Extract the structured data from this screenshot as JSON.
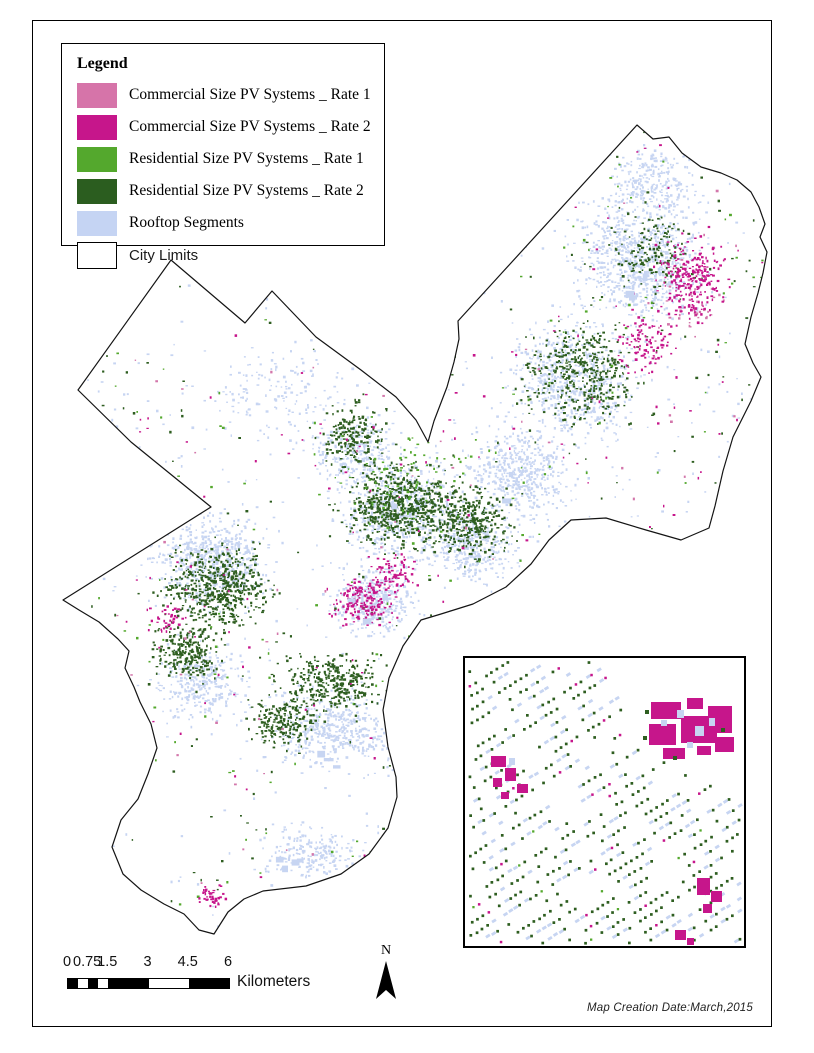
{
  "legend": {
    "title": "Legend",
    "items": [
      {
        "label": "Commercial Size PV Systems _ Rate 1",
        "color": "#d674a9",
        "outlined": false,
        "sans": false
      },
      {
        "label": "Commercial Size PV Systems _ Rate 2",
        "color": "#c6168b",
        "outlined": false,
        "sans": false
      },
      {
        "label": "Residential Size PV Systems _ Rate 1",
        "color": "#54a82d",
        "outlined": false,
        "sans": false
      },
      {
        "label": "Residential Size PV Systems _ Rate 2",
        "color": "#2b5d1f",
        "outlined": false,
        "sans": false
      },
      {
        "label": "Rooftop Segments",
        "color": "#c5d4f3",
        "outlined": false,
        "sans": false
      },
      {
        "label": "City Limits",
        "color": "#ffffff",
        "outlined": true,
        "sans": true
      }
    ]
  },
  "scalebar": {
    "unit": "Kilometers",
    "max_km": 6,
    "bar_px": 161,
    "tick_labels": [
      {
        "km": 0,
        "text": "0"
      },
      {
        "km": 0.75,
        "text": "0.75"
      },
      {
        "km": 1.5,
        "text": "1.5"
      },
      {
        "km": 3,
        "text": "3"
      },
      {
        "km": 4.5,
        "text": "4.5"
      },
      {
        "km": 6,
        "text": "6"
      }
    ],
    "segments": [
      {
        "from": 0,
        "to": 0.375,
        "fill": "#000000"
      },
      {
        "from": 0.375,
        "to": 0.75,
        "fill": "#ffffff"
      },
      {
        "from": 0.75,
        "to": 1.125,
        "fill": "#000000"
      },
      {
        "from": 1.125,
        "to": 1.5,
        "fill": "#ffffff"
      },
      {
        "from": 1.5,
        "to": 3,
        "fill": "#000000"
      },
      {
        "from": 3,
        "to": 4.5,
        "fill": "#ffffff"
      },
      {
        "from": 4.5,
        "to": 6,
        "fill": "#000000"
      }
    ]
  },
  "north_arrow": {
    "label": "N"
  },
  "footer": {
    "date_note": "Map Creation Date:March,2015"
  },
  "map": {
    "seed": 1337,
    "colors": {
      "com1": "#d377ab",
      "com2": "#c6168b",
      "res1": "#54a82d",
      "res2": "#2e5e20",
      "rooftop": "#c7d5f2",
      "outline": "#141414"
    },
    "outline_points": [
      [
        636,
        124
      ],
      [
        652,
        138
      ],
      [
        668,
        136
      ],
      [
        681,
        152
      ],
      [
        700,
        166
      ],
      [
        720,
        172
      ],
      [
        736,
        179
      ],
      [
        750,
        191
      ],
      [
        758,
        206
      ],
      [
        764,
        223
      ],
      [
        759,
        236
      ],
      [
        766,
        251
      ],
      [
        762,
        272
      ],
      [
        757,
        292
      ],
      [
        750,
        316
      ],
      [
        744,
        343
      ],
      [
        752,
        362
      ],
      [
        760,
        376
      ],
      [
        750,
        400
      ],
      [
        732,
        436
      ],
      [
        722,
        470
      ],
      [
        714,
        505
      ],
      [
        708,
        527
      ],
      [
        680,
        539
      ],
      [
        645,
        529
      ],
      [
        605,
        517
      ],
      [
        570,
        519
      ],
      [
        548,
        539
      ],
      [
        530,
        563
      ],
      [
        505,
        586
      ],
      [
        472,
        603
      ],
      [
        440,
        613
      ],
      [
        420,
        619
      ],
      [
        402,
        645
      ],
      [
        388,
        677
      ],
      [
        382,
        709
      ],
      [
        387,
        746
      ],
      [
        395,
        776
      ],
      [
        396,
        796
      ],
      [
        387,
        827
      ],
      [
        368,
        853
      ],
      [
        340,
        873
      ],
      [
        305,
        885
      ],
      [
        262,
        890
      ],
      [
        243,
        898
      ],
      [
        227,
        911
      ],
      [
        213,
        933
      ],
      [
        198,
        929
      ],
      [
        183,
        913
      ],
      [
        163,
        903
      ],
      [
        140,
        889
      ],
      [
        122,
        873
      ],
      [
        111,
        846
      ],
      [
        120,
        819
      ],
      [
        137,
        798
      ],
      [
        147,
        773
      ],
      [
        156,
        747
      ],
      [
        150,
        723
      ],
      [
        139,
        701
      ],
      [
        133,
        686
      ],
      [
        124,
        667
      ],
      [
        128,
        650
      ],
      [
        117,
        638
      ],
      [
        98,
        621
      ],
      [
        78,
        609
      ],
      [
        62,
        599
      ],
      [
        210,
        506
      ],
      [
        130,
        441
      ],
      [
        77,
        389
      ],
      [
        170,
        259
      ],
      [
        244,
        322
      ],
      [
        271,
        290
      ],
      [
        315,
        336
      ],
      [
        360,
        369
      ],
      [
        395,
        396
      ],
      [
        415,
        419
      ],
      [
        427,
        441
      ],
      [
        433,
        420
      ],
      [
        446,
        386
      ],
      [
        453,
        361
      ],
      [
        458,
        338
      ],
      [
        457,
        320
      ]
    ],
    "voids": [
      [
        300,
        380,
        55,
        55
      ],
      [
        300,
        545,
        45,
        48
      ],
      [
        200,
        330,
        60,
        45
      ],
      [
        330,
        790,
        58,
        48
      ],
      [
        180,
        820,
        60,
        48
      ]
    ],
    "clusters": {
      "rooftop": [
        [
          640,
          260,
          85,
          85,
          800
        ],
        [
          650,
          180,
          60,
          45,
          250
        ],
        [
          570,
          380,
          85,
          75,
          600
        ],
        [
          520,
          470,
          70,
          60,
          450
        ],
        [
          400,
          510,
          80,
          70,
          600
        ],
        [
          470,
          545,
          55,
          50,
          350
        ],
        [
          370,
          600,
          55,
          45,
          350
        ],
        [
          210,
          560,
          80,
          65,
          600
        ],
        [
          200,
          680,
          60,
          50,
          300
        ],
        [
          330,
          730,
          80,
          60,
          500
        ],
        [
          310,
          850,
          70,
          40,
          220
        ],
        [
          280,
          390,
          90,
          70,
          280
        ],
        [
          350,
          450,
          60,
          45,
          250
        ],
        [
          416,
          530,
          354,
          406,
          900,
          1
        ]
      ],
      "res2": [
        [
          395,
          505,
          75,
          60,
          600
        ],
        [
          465,
          520,
          60,
          50,
          350
        ],
        [
          215,
          585,
          70,
          55,
          550
        ],
        [
          185,
          650,
          45,
          40,
          250
        ],
        [
          580,
          370,
          75,
          70,
          400
        ],
        [
          330,
          680,
          75,
          40,
          330
        ],
        [
          280,
          720,
          45,
          35,
          200
        ],
        [
          350,
          430,
          50,
          45,
          220
        ],
        [
          650,
          250,
          55,
          55,
          150
        ],
        [
          416,
          530,
          354,
          406,
          420,
          1
        ]
      ],
      "com2": [
        [
          690,
          278,
          45,
          60,
          250
        ],
        [
          640,
          340,
          40,
          45,
          100
        ],
        [
          360,
          600,
          45,
          35,
          180
        ],
        [
          395,
          570,
          30,
          25,
          70
        ],
        [
          210,
          895,
          20,
          14,
          40
        ],
        [
          165,
          615,
          25,
          18,
          40
        ],
        [
          416,
          530,
          354,
          406,
          280,
          1
        ]
      ],
      "res1": [
        [
          400,
          480,
          100,
          80,
          80
        ],
        [
          416,
          530,
          354,
          406,
          300,
          1
        ]
      ],
      "com1": [
        [
          690,
          300,
          45,
          55,
          40
        ],
        [
          416,
          530,
          354,
          406,
          160,
          1
        ]
      ]
    },
    "patch_anchors": [
      [
        330,
        730
      ],
      [
        210,
        560
      ],
      [
        400,
        510
      ],
      [
        310,
        850
      ],
      [
        520,
        470
      ],
      [
        370,
        600
      ],
      [
        640,
        300
      ]
    ],
    "patch_count": 16
  },
  "inset": {
    "seed": 777,
    "row_spacing": 13.2,
    "row_angle_deg": 32,
    "void_polygon": [
      [
        138,
        0
      ],
      [
        279,
        0
      ],
      [
        279,
        146
      ],
      [
        204,
        104
      ],
      [
        146,
        36
      ]
    ],
    "blocks": [
      {
        "x": 186,
        "y": 44,
        "w": 30,
        "h": 17,
        "c": "com2"
      },
      {
        "x": 222,
        "y": 40,
        "w": 16,
        "h": 11,
        "c": "com2"
      },
      {
        "x": 243,
        "y": 48,
        "w": 24,
        "h": 27,
        "c": "com2"
      },
      {
        "x": 184,
        "y": 66,
        "w": 27,
        "h": 21,
        "c": "com2"
      },
      {
        "x": 216,
        "y": 58,
        "w": 36,
        "h": 27,
        "c": "com2"
      },
      {
        "x": 250,
        "y": 79,
        "w": 19,
        "h": 15,
        "c": "com2"
      },
      {
        "x": 198,
        "y": 90,
        "w": 22,
        "h": 11,
        "c": "com2"
      },
      {
        "x": 232,
        "y": 88,
        "w": 14,
        "h": 9,
        "c": "com2"
      },
      {
        "x": 212,
        "y": 52,
        "w": 7,
        "h": 8,
        "c": "rooftop"
      },
      {
        "x": 230,
        "y": 68,
        "w": 9,
        "h": 10,
        "c": "rooftop"
      },
      {
        "x": 196,
        "y": 62,
        "w": 6,
        "h": 6,
        "c": "rooftop"
      },
      {
        "x": 244,
        "y": 60,
        "w": 6,
        "h": 8,
        "c": "rooftop"
      },
      {
        "x": 222,
        "y": 84,
        "w": 6,
        "h": 6,
        "c": "rooftop"
      },
      {
        "x": 180,
        "y": 52,
        "w": 4,
        "h": 4,
        "c": "res2"
      },
      {
        "x": 256,
        "y": 70,
        "w": 4,
        "h": 4,
        "c": "res2"
      },
      {
        "x": 208,
        "y": 98,
        "w": 4,
        "h": 4,
        "c": "res2"
      },
      {
        "x": 178,
        "y": 78,
        "w": 4,
        "h": 4,
        "c": "res2"
      },
      {
        "x": 26,
        "y": 98,
        "w": 15,
        "h": 11,
        "c": "com2"
      },
      {
        "x": 40,
        "y": 110,
        "w": 11,
        "h": 13,
        "c": "com2"
      },
      {
        "x": 28,
        "y": 120,
        "w": 9,
        "h": 9,
        "c": "com2"
      },
      {
        "x": 52,
        "y": 126,
        "w": 11,
        "h": 9,
        "c": "com2"
      },
      {
        "x": 36,
        "y": 134,
        "w": 8,
        "h": 7,
        "c": "com2"
      },
      {
        "x": 44,
        "y": 100,
        "w": 6,
        "h": 7,
        "c": "rooftop"
      },
      {
        "x": 232,
        "y": 220,
        "w": 13,
        "h": 17,
        "c": "com2"
      },
      {
        "x": 246,
        "y": 233,
        "w": 11,
        "h": 11,
        "c": "com2"
      },
      {
        "x": 238,
        "y": 246,
        "w": 9,
        "h": 9,
        "c": "com2"
      },
      {
        "x": 210,
        "y": 272,
        "w": 11,
        "h": 10,
        "c": "com2"
      },
      {
        "x": 222,
        "y": 280,
        "w": 7,
        "h": 7,
        "c": "com2"
      }
    ]
  }
}
